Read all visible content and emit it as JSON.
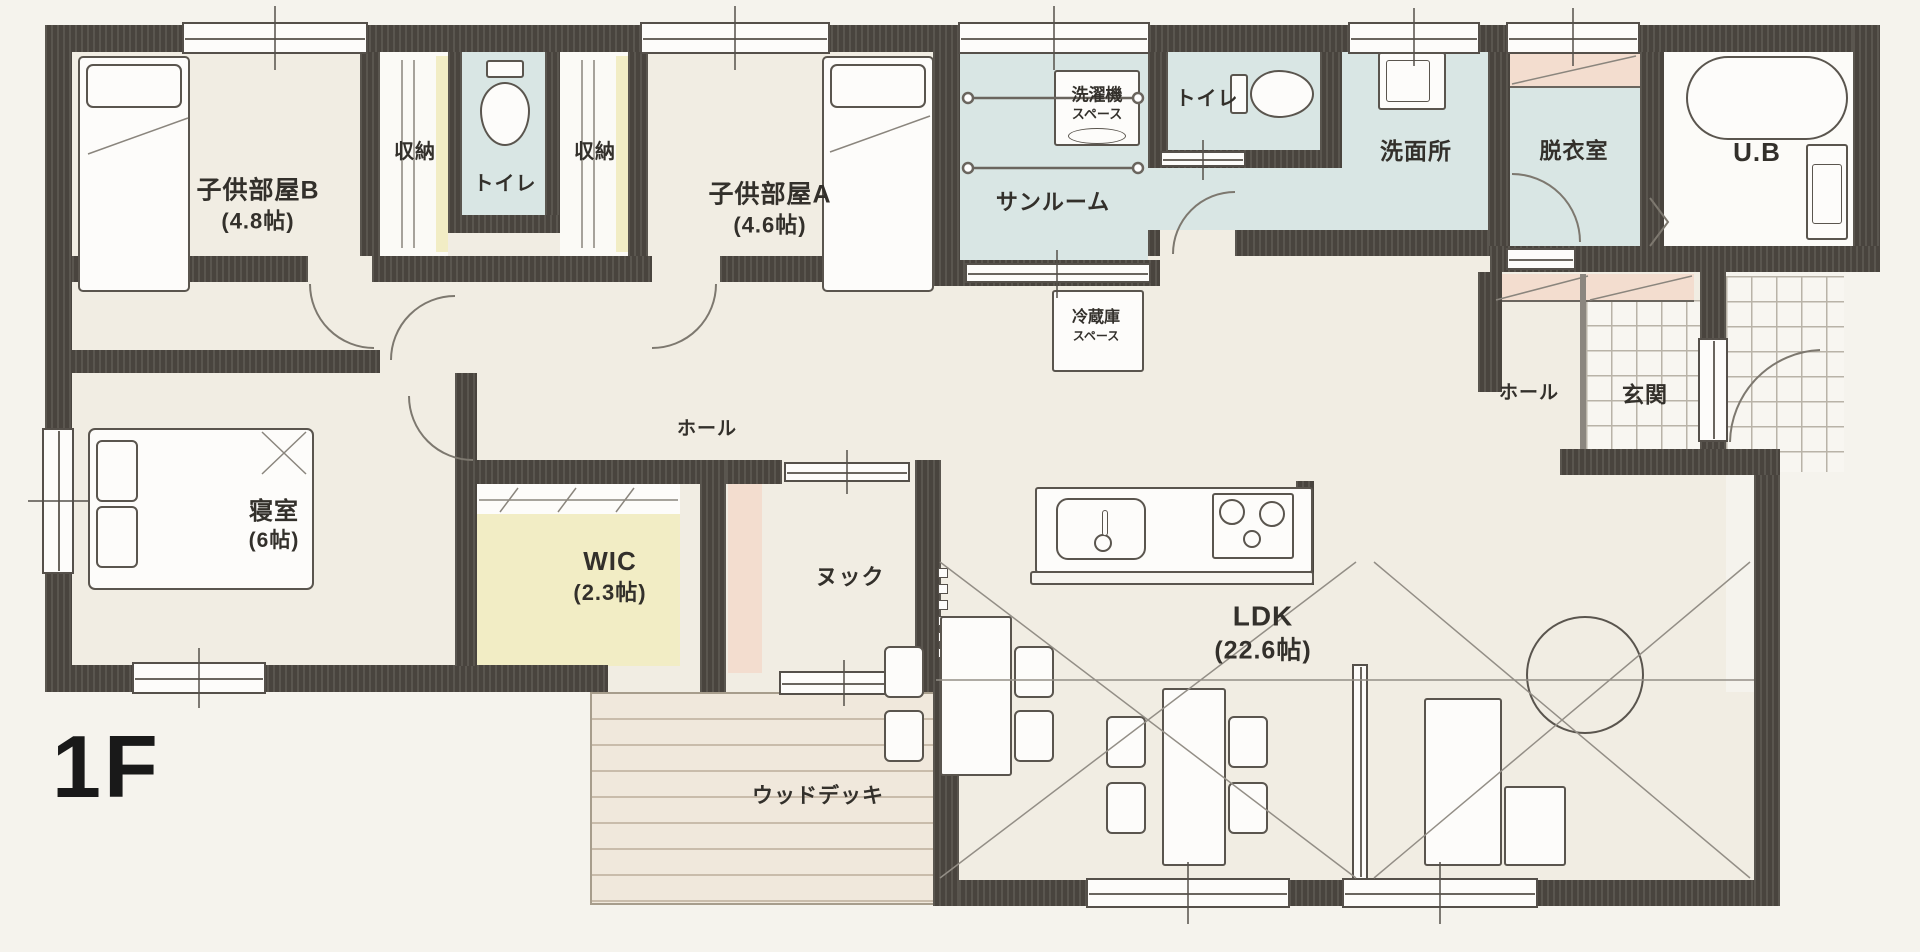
{
  "floor_plan": {
    "floor_label": "1F",
    "rooms": {
      "kids_room_b": {
        "name": "子供部屋B",
        "size": "(4.8帖)"
      },
      "closet_b": {
        "name": "収納"
      },
      "toilet_1": {
        "name": "トイレ"
      },
      "closet_a": {
        "name": "収納"
      },
      "kids_room_a": {
        "name": "子供部屋A",
        "size": "(4.6帖)"
      },
      "sunroom": {
        "name": "サンルーム"
      },
      "washer_space": {
        "line1": "洗濯機",
        "line2": "スペース"
      },
      "toilet_2": {
        "name": "トイレ"
      },
      "washroom": {
        "name": "洗面所"
      },
      "dressing_room": {
        "name": "脱衣室"
      },
      "unit_bath": {
        "name": "U.B"
      },
      "fridge_space": {
        "line1": "冷蔵庫",
        "line2": "スペース"
      },
      "hall_center": {
        "name": "ホール"
      },
      "hall_entrance": {
        "name": "ホール"
      },
      "entrance": {
        "name": "玄関"
      },
      "bedroom": {
        "name": "寝室",
        "size": "(6帖)"
      },
      "wic": {
        "name": "WIC",
        "size": "(2.3帖)"
      },
      "nook": {
        "name": "ヌック"
      },
      "ldk": {
        "name": "LDK",
        "size": "(22.6帖)"
      },
      "wood_deck": {
        "name": "ウッドデッキ"
      }
    },
    "colors": {
      "paper": "#f5f3ed",
      "floor_cream": "#f1ede3",
      "wall_dark": "#49443e",
      "wet_area_blue": "#d9e6e4",
      "closet_yellow": "#f2edc5",
      "accent_pink": "#f3ddcf",
      "deck_wood": "#f0e8dc",
      "line_ink": "#5a554e"
    }
  }
}
